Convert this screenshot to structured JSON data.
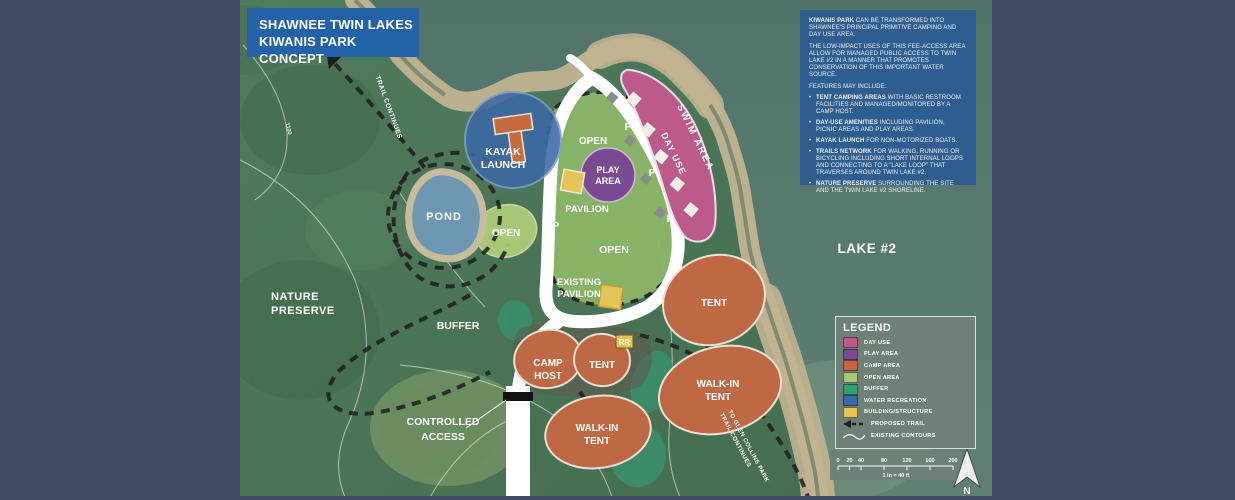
{
  "title_box": {
    "line1": "SHAWNEE TWIN LAKES",
    "line2": "KIWANIS PARK CONCEPT"
  },
  "description_box": {
    "p1_bold": "KIWANIS PARK",
    "p1_rest": " CAN BE TRANSFORMED INTO SHAWNEE'S PRINCIPAL PRIMITIVE CAMPING AND DAY USE AREA.",
    "p2": "THE LOW-IMPACT USES OF THIS FEE-ACCESS AREA ALLOW FOR MANAGED PUBLIC ACCESS TO TWIN LAKE #2 IN A MANNER THAT PROMOTES CONSERVATION OF THIS IMPORTANT WATER SOURCE.",
    "features_heading": "FEATURES MAY INCLUDE:",
    "bullets": [
      {
        "bold": "TENT CAMPING AREAS",
        "rest": " WITH BASIC RESTROOM FACILITIES AND MANAGED/MONITORED BY A CAMP HOST."
      },
      {
        "bold": "DAY-USE AMENITIES",
        "rest": " INCLUDING PAVILION, PICNIC AREAS AND PLAY AREAS."
      },
      {
        "bold": "KAYAK LAUNCH",
        "rest": " FOR NON-MOTORIZED BOATS."
      },
      {
        "bold": "TRAILS NETWORK",
        "rest": " FOR WALKING, RUNNING OR BICYCLING INCLUDING SHORT INTERNAL LOOPS AND CONNECTING TO A \"LAKE LOOP\" THAT TRAVERSES AROUND TWIN LAKE #2."
      },
      {
        "bold": "NATURE PRESERVE",
        "rest": " SURROUNDING THE SITE AND THE TWIN LAKE #2 SHORELINE."
      }
    ]
  },
  "legend": {
    "title": "LEGEND",
    "items": [
      {
        "label": "DAY USE",
        "color": "#c2568e"
      },
      {
        "label": "PLAY AREA",
        "color": "#7a4a92"
      },
      {
        "label": "CAMP AREA",
        "color": "#cc6240"
      },
      {
        "label": "OPEN AREA",
        "color": "#a9c877"
      },
      {
        "label": "BUFFER",
        "color": "#2da377"
      },
      {
        "label": "WATER RECREATION",
        "color": "#3b69a5"
      },
      {
        "label": "BUILDING/STRUCTURE",
        "color": "#e5c455"
      },
      {
        "label": "PROPOSED TRAIL",
        "icon": "trail-arrow-icon"
      },
      {
        "label": "EXISTING CONTOURS",
        "icon": "contour-line-icon"
      }
    ]
  },
  "map": {
    "labels": {
      "trail_continues_top": "TRAIL CONTINUES",
      "contour_elevation": "1100",
      "kayak_launch": [
        "KAYAK",
        "LAUNCH"
      ],
      "pond": "POND",
      "open_west": "OPEN",
      "open_north": "OPEN",
      "open_center": "OPEN",
      "play_area": [
        "PLAY",
        "AREA"
      ],
      "pavilion": "PAVILION",
      "existing_pavilion": [
        "EXISTING",
        "PAVILION"
      ],
      "nature_preserve": [
        "NATURE",
        "PRESERVE"
      ],
      "buffer": "BUFFER",
      "day_use": "DAY USE",
      "swim_area": "SWIM AREA",
      "lake_2": "LAKE #2",
      "camp_host": [
        "CAMP",
        "HOST"
      ],
      "tent_north": "TENT",
      "tent_east": "TENT",
      "walk_in_tent_east": [
        "WALK-IN",
        "TENT"
      ],
      "walk_in_tent_south": [
        "WALK-IN",
        "TENT"
      ],
      "controlled_access": [
        "CONTROLLED",
        "ACCESS"
      ],
      "patterson_rd": "PATTERSON RD",
      "trail_continues_bottom": [
        "TRAIL CONTINUES",
        "TO GLEN COLLINS PARK"
      ],
      "restroom": "RR",
      "parking": "P"
    }
  },
  "scale_bar": {
    "ticks": [
      "0",
      "20",
      "40",
      "80",
      "120",
      "160",
      "200"
    ],
    "caption": "1 in = 40 ft"
  },
  "compass": {
    "north": "N"
  },
  "colors": {
    "side_panel": "#3d4a62",
    "title_box": "#2262a8",
    "description_box": "#2e5e90",
    "legend_bg": "#6f8177",
    "water": "#57796c",
    "forest": "#4c7859",
    "beach": "#c2b491",
    "road": "#ffffff",
    "proposed_trail": "#1d1d1d",
    "existing_contour": "#ffffff"
  }
}
